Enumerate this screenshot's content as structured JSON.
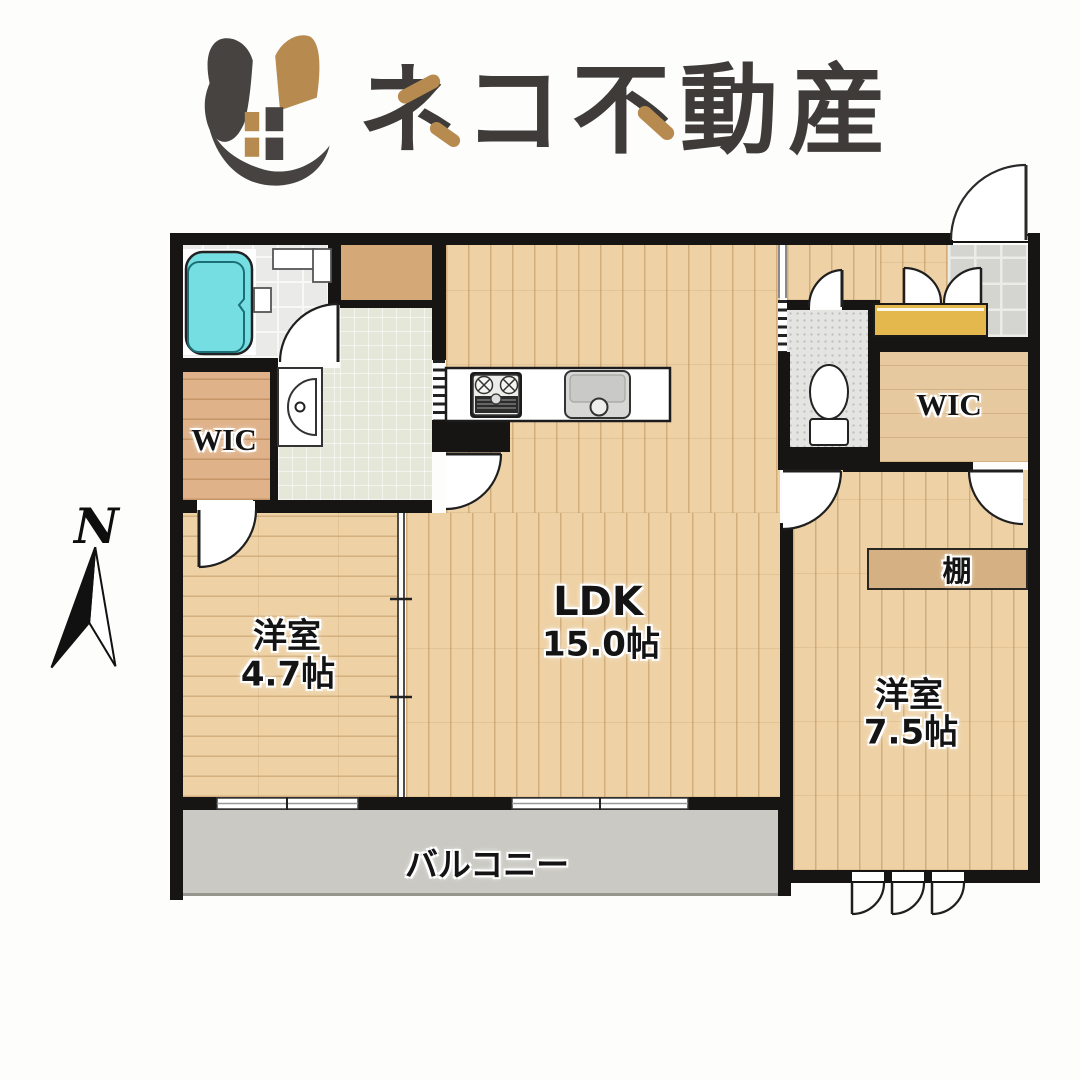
{
  "brand": {
    "name": "ネコ不動産",
    "icon": "cat-house-icon",
    "color_dark": "#3f3b38",
    "color_tan": "#b78b50"
  },
  "compass": {
    "label": "N"
  },
  "plan": {
    "rooms": {
      "ldk": {
        "label": "LDK",
        "area": "15.0帖"
      },
      "bedroom_small": {
        "label": "洋室",
        "area": "4.7帖"
      },
      "bedroom_large": {
        "label": "洋室",
        "area": "7.5帖"
      },
      "wic_left": {
        "label": "WIC"
      },
      "wic_right": {
        "label": "WIC"
      },
      "shelf": {
        "label": "棚"
      },
      "balcony": {
        "label": "バルコニー"
      }
    },
    "fixtures": {
      "bathtub": "bathtub-icon",
      "washbasin": "washbasin-icon",
      "toilet": "toilet-icon",
      "stove": "gas-stove-icon",
      "sink": "kitchen-sink-icon",
      "shoe_cabinet": "shoe-cabinet",
      "entrance_door": "entrance-door"
    },
    "colors": {
      "wall": "#171513",
      "wood": "#eed2a6",
      "wood_line": "#ba8f56",
      "wic_wood": "#dfb28a",
      "storage": "#d4a877",
      "washroom": "#e5e8d9",
      "bathtub": "#74dee2",
      "balcony": "#cac9c3",
      "cabinet": "#e5b84e",
      "genkan_tile": "#d4d4d1",
      "toilet_floor": "#e4e4e2"
    }
  }
}
